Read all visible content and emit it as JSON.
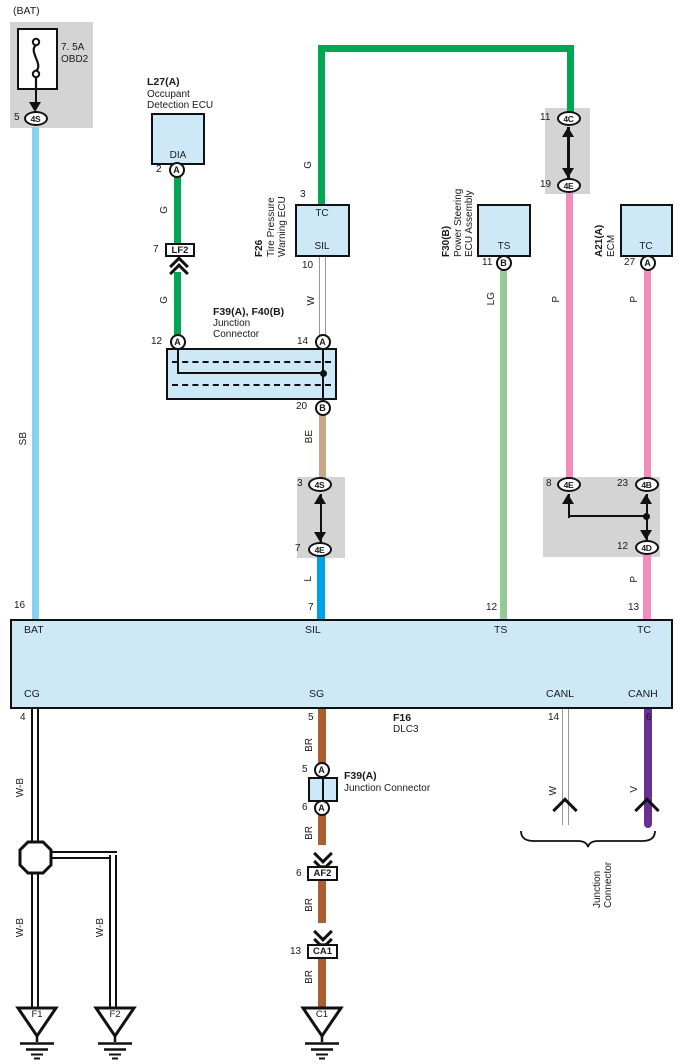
{
  "colors": {
    "green": "#00A651",
    "light_green": "#92CA98",
    "sky_blue": "#8AD2F2",
    "blue": "#00A2E5",
    "pink": "#F28CBA",
    "brown": "#AB5E31",
    "beige": "#C6A787",
    "purple": "#6A3091",
    "box_fill": "#CDE9F8",
    "shield": "#D4D4D4"
  },
  "fuse": {
    "caption": "(BAT)",
    "rating": "7. 5A",
    "name": "OBD2",
    "pin": "5",
    "conn": "4S"
  },
  "wires": {
    "sb": "SB",
    "g": "G",
    "w": "W",
    "lg": "LG",
    "p": "P",
    "be": "BE",
    "l": "L",
    "br": "BR",
    "wb": "W-B",
    "v": "V"
  },
  "occupant_ecu": {
    "code": "L27(A)",
    "name1": "Occupant",
    "name2": "Detection ECU",
    "terminal": "DIA",
    "pin": "2",
    "conn": "A"
  },
  "lf2": {
    "pin": "7",
    "label": "LF2"
  },
  "junction_main": {
    "code": "F39(A), F40(B)",
    "name1": "Junction",
    "name2": "Connector",
    "pin_left": "12",
    "pin_right": "14",
    "pin_bottom": "20",
    "conn_a": "A",
    "conn_b": "B"
  },
  "tire_ecu": {
    "code": "F26",
    "name1": "Tire Pressure",
    "name2": "Warning ECU",
    "term_top": "TC",
    "term_bottom": "SIL",
    "pin_top": "3",
    "pin_bottom": "10"
  },
  "steering_ecu": {
    "code": "F30(B)",
    "name1": "Power Steering",
    "name2": "ECU Assembly",
    "terminal": "TS",
    "pin": "11",
    "conn": "B"
  },
  "ecm": {
    "code": "A21(A)",
    "name": "ECM",
    "terminal": "TC",
    "pin": "27",
    "conn": "A"
  },
  "conn_tr": {
    "pin_top": "11",
    "conn_top": "4C",
    "pin_bottom": "19",
    "conn_bottom": "4E"
  },
  "conn_mid": {
    "pin_top": "3",
    "conn_top": "4S",
    "pin_bottom": "7",
    "conn_bottom": "4E"
  },
  "conn_right": {
    "pin_left": "8",
    "conn_left": "4E",
    "pin_right": "23",
    "conn_right": "4B",
    "pin_bottom": "12",
    "conn_bottom": "4D"
  },
  "dlc3": {
    "code": "F16",
    "name": "DLC3",
    "t_bat": "BAT",
    "t_sil": "SIL",
    "t_ts": "TS",
    "t_tc": "TC",
    "t_cg": "CG",
    "t_sg": "SG",
    "t_canl": "CANL",
    "t_canh": "CANH",
    "pin_bat": "16",
    "pin_sil": "7",
    "pin_ts": "12",
    "pin_tc": "13",
    "pin_cg": "4",
    "pin_sg": "5",
    "pin_canl": "14",
    "pin_canh": "6"
  },
  "junction_small": {
    "code": "F39(A)",
    "name": "Junction Connector",
    "pin_top": "5",
    "pin_bottom": "6",
    "conn": "A"
  },
  "af2": {
    "pin": "6",
    "label": "AF2"
  },
  "ca1": {
    "pin": "13",
    "label": "CA1"
  },
  "grounds": {
    "f1": "F1",
    "f2": "F2",
    "c1": "C1"
  },
  "brace": {
    "name1": "Junction",
    "name2": "Connector"
  }
}
